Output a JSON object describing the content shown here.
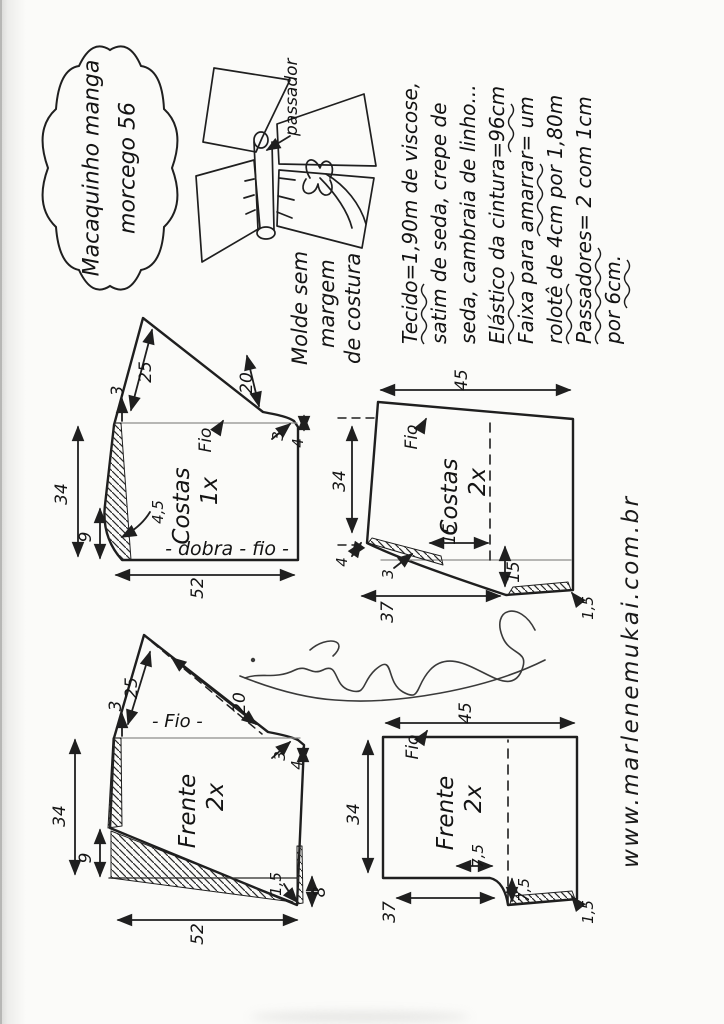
{
  "title": {
    "line1": "Macaquinho manga",
    "line2": "morcego 56"
  },
  "sketch": {
    "passador_label": "passador"
  },
  "note": {
    "line1": "Molde sem",
    "line2": "margem",
    "line3": "de costura"
  },
  "materials": {
    "lines": [
      "Tecido=1,90m de viscose,",
      "satim de seda, crepe de",
      "seda, cambraia de linho...",
      "Elástico da cintura=96cm",
      "Faixa para amarrar= um",
      "rolotê de 4cm por 1,80m",
      "Passadores= 2 com 1cm",
      "por 6cm."
    ]
  },
  "website": "www.marlenemukai.com.br",
  "pieces": {
    "costas_top": {
      "name": "Costas",
      "qty": "1x",
      "grain": "Fio",
      "fold_label": "- dobra - fio -",
      "shoulder": "25",
      "cuff": "20",
      "ext": "3",
      "underarm_w": "3",
      "underarm_h": "4",
      "width": "34",
      "hem_rise": "9",
      "curve": "4,5",
      "length": "52"
    },
    "costas_shorts": {
      "name": "Costas",
      "qty": "2x",
      "grain": "Fio",
      "waist": "45",
      "side": "34",
      "step": "4",
      "drop": "3",
      "hem": "37",
      "crotch_w": "15",
      "crotch_h": "15",
      "hem_rise": "1,5"
    },
    "frente_top": {
      "name": "Frente",
      "qty": "2x",
      "grain": "- Fio -",
      "shoulder": "25",
      "cuff": "20",
      "ext": "3",
      "underarm_w": "3",
      "underarm_h": "4",
      "width": "34",
      "hem_rise": "9",
      "length": "52",
      "dip": "8",
      "corner": "1,5"
    },
    "frente_shorts": {
      "name": "Frente",
      "qty": "2x",
      "grain": "Fio",
      "waist": "45",
      "side": "34",
      "hem": "37",
      "crotch_w": "7,5",
      "crotch_h": "7,5",
      "hem_rise": "1,5"
    }
  }
}
